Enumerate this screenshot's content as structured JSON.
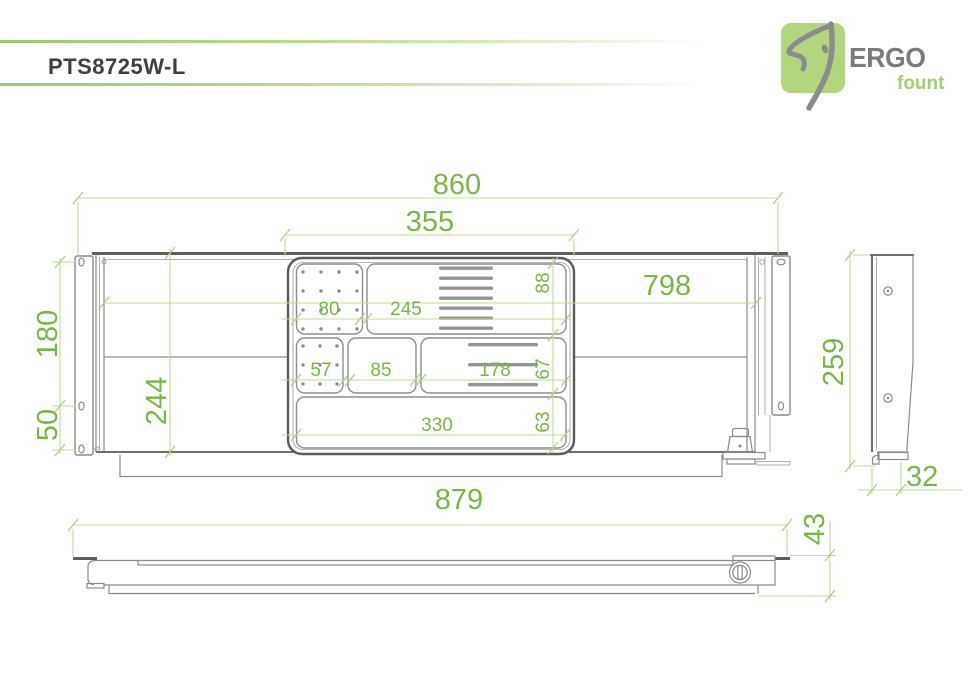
{
  "header": {
    "title": "PTS8725W-L"
  },
  "logo": {
    "brand": "ERGO",
    "tagline": "fount"
  },
  "colors": {
    "accent_green": "#79b649",
    "dim_line_green": "#c0dc9c",
    "drawing_gray": "#8a8a8a",
    "logo_square_green": "#b2d57d",
    "title_gray": "#3f3f3f"
  },
  "dims": {
    "overall_width": "860",
    "tray_width": "355",
    "body_inner_width": "798",
    "bracket_hole_span": "180",
    "bracket_hole_lower": "50",
    "inner_height": "244",
    "tray_cell_80": "80",
    "tray_cell_245": "245",
    "tray_cell_57": "57",
    "tray_cell_85": "85",
    "tray_cell_178": "178",
    "tray_cell_330": "330",
    "tray_row_88": "88",
    "tray_row_67": "67",
    "tray_row_63": "63",
    "side_height": "259",
    "side_depth": "32",
    "bottom_length": "879",
    "bottom_height": "43"
  }
}
